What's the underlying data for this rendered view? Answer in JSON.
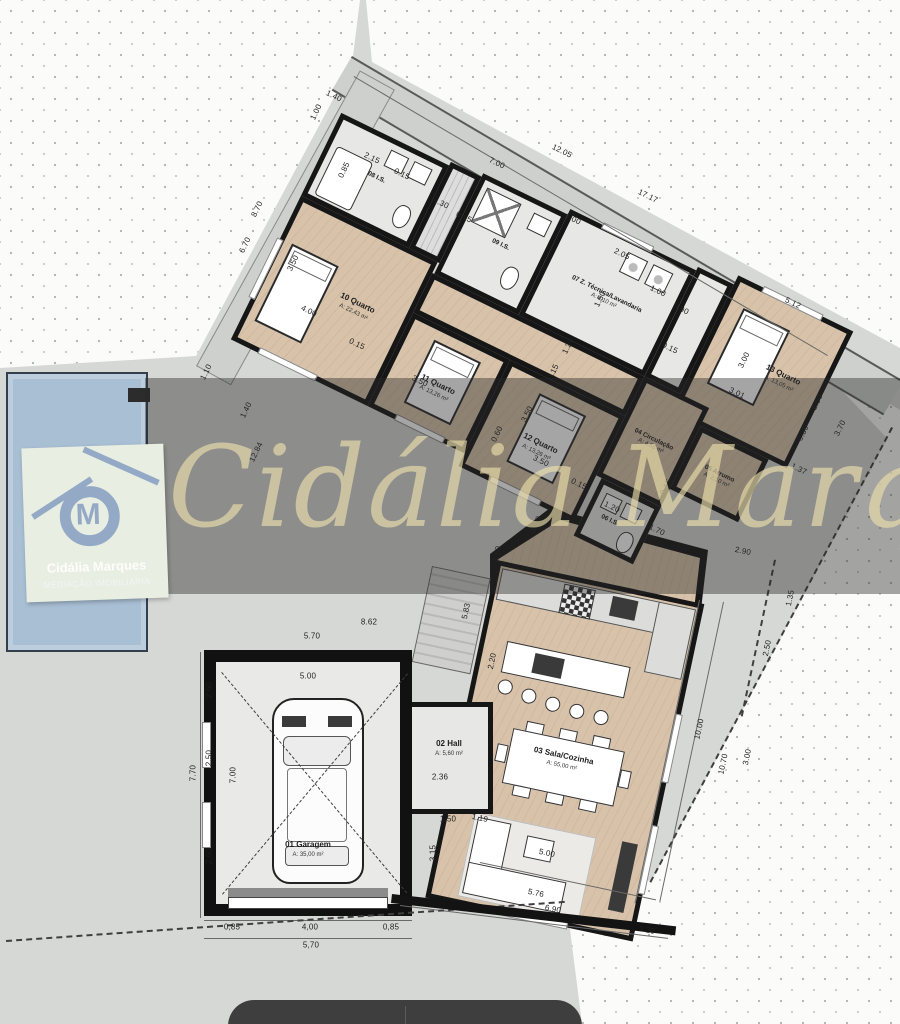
{
  "watermark": {
    "script_text": "Cidália Marques"
  },
  "logo": {
    "monogram": "M",
    "line1": "Cidália Marques",
    "line2": "MEDIAÇÃO IMOBILIÁRIA"
  },
  "rooms": {
    "r10": {
      "name": "10 Quarto",
      "area": "A: 22,43 m²"
    },
    "r11": {
      "name": "11 Quarto",
      "area": "A: 13,26 m²"
    },
    "r12": {
      "name": "12 Quarto",
      "area": "A: 13,26 m²"
    },
    "r13": {
      "name": "13 Quarto",
      "area": "A: 13,05 m²"
    },
    "is08": {
      "name": "08 I.S.",
      "area": "A: 5,13 m²"
    },
    "is09": {
      "name": "09 I.S.",
      "area": "A: 4,50 m²"
    },
    "laundry": {
      "name": "07 Z. Técnica/Lavandaria",
      "area": "A: 8,10 m²"
    },
    "arrumo": {
      "name": "05 Arrumo",
      "area": "A: 2,10 m²"
    },
    "circ": {
      "name": "04 Circulação",
      "area": "A: 4,65 m²"
    },
    "wc06": {
      "name": "06 I.S.",
      "area": "A: 2,40 m²"
    },
    "sala": {
      "name": "03 Sala/Cozinha",
      "area": "A: 55,00 m²"
    },
    "hall": {
      "name": "02 Hall",
      "area": "A: 5,60 m²"
    },
    "garage": {
      "name": "01 Garagem",
      "area": "A: 35,00 m²"
    }
  },
  "colors": {
    "wall": "#161616",
    "wood_floor": "#d8c3aa",
    "tile_floor": "#e7e7e5",
    "pool": "#a9bfd4",
    "watermark_band": "rgba(40,40,40,0.42)",
    "script_gold": "rgba(235,222,170,0.65)",
    "logo_mark": "#93a9c6",
    "logo_bg": "#e8eee1"
  },
  "dims": [
    {
      "t": "1.40",
      "x": 334,
      "y": 96,
      "r": 26
    },
    {
      "t": "1.00",
      "x": 316,
      "y": 112,
      "r": -64
    },
    {
      "t": "2.15",
      "x": 372,
      "y": 158,
      "r": 26
    },
    {
      "t": "0.85",
      "x": 344,
      "y": 170,
      "r": -64
    },
    {
      "t": "0.15",
      "x": 402,
      "y": 174,
      "r": 26
    },
    {
      "t": "7.00",
      "x": 497,
      "y": 163,
      "r": 26
    },
    {
      "t": "12.05",
      "x": 562,
      "y": 151,
      "r": 26
    },
    {
      "t": "17.17",
      "x": 648,
      "y": 196,
      "r": 26
    },
    {
      "t": "1.00",
      "x": 573,
      "y": 219,
      "r": 26
    },
    {
      "t": "2.05",
      "x": 622,
      "y": 254,
      "r": 26
    },
    {
      "t": "1.00",
      "x": 658,
      "y": 291,
      "r": 26
    },
    {
      "t": "0.90",
      "x": 681,
      "y": 309,
      "r": 26
    },
    {
      "t": "5.12",
      "x": 793,
      "y": 303,
      "r": 26
    },
    {
      "t": "2.30",
      "x": 441,
      "y": 203,
      "r": 26
    },
    {
      "t": "0.15",
      "x": 464,
      "y": 217,
      "r": 26
    },
    {
      "t": "8.70",
      "x": 257,
      "y": 209,
      "r": -64
    },
    {
      "t": "6.70",
      "x": 245,
      "y": 245,
      "r": -64
    },
    {
      "t": "1.10",
      "x": 206,
      "y": 372,
      "r": -64
    },
    {
      "t": "1.40",
      "x": 246,
      "y": 410,
      "r": -64
    },
    {
      "t": "3.50",
      "x": 293,
      "y": 263,
      "r": -64
    },
    {
      "t": "4.00",
      "x": 309,
      "y": 311,
      "r": 26
    },
    {
      "t": "0.15",
      "x": 357,
      "y": 344,
      "r": 26
    },
    {
      "t": "3.50",
      "x": 420,
      "y": 381,
      "r": 26
    },
    {
      "t": "12.84",
      "x": 256,
      "y": 452,
      "r": -64
    },
    {
      "t": "3.50",
      "x": 527,
      "y": 414,
      "r": -64
    },
    {
      "t": "0.60",
      "x": 497,
      "y": 434,
      "r": -64
    },
    {
      "t": "3.50",
      "x": 541,
      "y": 461,
      "r": 26
    },
    {
      "t": "0.15",
      "x": 579,
      "y": 484,
      "r": 26
    },
    {
      "t": "1.20",
      "x": 612,
      "y": 507,
      "r": 26
    },
    {
      "t": "1.10",
      "x": 536,
      "y": 524,
      "r": -64
    },
    {
      "t": "1.50",
      "x": 600,
      "y": 299,
      "r": -64
    },
    {
      "t": "1.20",
      "x": 568,
      "y": 346,
      "r": -64
    },
    {
      "t": "0.15",
      "x": 553,
      "y": 372,
      "r": -64
    },
    {
      "t": "0.15",
      "x": 670,
      "y": 348,
      "r": 26
    },
    {
      "t": "2.93",
      "x": 684,
      "y": 458,
      "r": -64
    },
    {
      "t": "0.15",
      "x": 666,
      "y": 487,
      "r": -64
    },
    {
      "t": "1.70",
      "x": 657,
      "y": 530,
      "r": 26
    },
    {
      "t": "3.01",
      "x": 737,
      "y": 393,
      "r": 26
    },
    {
      "t": "3.00",
      "x": 744,
      "y": 360,
      "r": -64
    },
    {
      "t": "2.50",
      "x": 817,
      "y": 402,
      "r": -64
    },
    {
      "t": "0.39",
      "x": 803,
      "y": 433,
      "r": -64
    },
    {
      "t": "3.70",
      "x": 840,
      "y": 428,
      "r": -64
    },
    {
      "t": "1.37",
      "x": 799,
      "y": 469,
      "r": 26
    },
    {
      "t": "2.90",
      "x": 743,
      "y": 551,
      "r": 12
    },
    {
      "t": "1.35",
      "x": 790,
      "y": 598,
      "r": -78
    },
    {
      "t": "2.50",
      "x": 767,
      "y": 648,
      "r": -78
    },
    {
      "t": "10.00",
      "x": 699,
      "y": 729,
      "r": -78
    },
    {
      "t": "10.70",
      "x": 723,
      "y": 764,
      "r": -78
    },
    {
      "t": "3.00",
      "x": 747,
      "y": 757,
      "r": -78
    },
    {
      "t": "5.00",
      "x": 547,
      "y": 853,
      "r": 12
    },
    {
      "t": "5.76",
      "x": 536,
      "y": 893,
      "r": 12
    },
    {
      "t": "6.90",
      "x": 553,
      "y": 909,
      "r": 12
    },
    {
      "t": "1.20",
      "x": 647,
      "y": 930,
      "r": 12
    },
    {
      "t": "8.62",
      "x": 369,
      "y": 622,
      "r": 0
    },
    {
      "t": "5.70",
      "x": 312,
      "y": 636,
      "r": 0
    },
    {
      "t": "5.00",
      "x": 308,
      "y": 676,
      "r": 0
    },
    {
      "t": "2.60",
      "x": 209,
      "y": 690,
      "r": -90
    },
    {
      "t": "2.50",
      "x": 209,
      "y": 758,
      "r": -90
    },
    {
      "t": "2.60",
      "x": 209,
      "y": 856,
      "r": -90
    },
    {
      "t": "7.70",
      "x": 193,
      "y": 773,
      "r": -90
    },
    {
      "t": "7.00",
      "x": 233,
      "y": 775,
      "r": -90
    },
    {
      "t": "0,85",
      "x": 232,
      "y": 927,
      "r": 0
    },
    {
      "t": "4,00",
      "x": 310,
      "y": 927,
      "r": 0
    },
    {
      "t": "0,85",
      "x": 391,
      "y": 927,
      "r": 0
    },
    {
      "t": "5,70",
      "x": 311,
      "y": 945,
      "r": 0
    },
    {
      "t": "3.15",
      "x": 433,
      "y": 853,
      "r": -90
    },
    {
      "t": "1,50",
      "x": 448,
      "y": 819,
      "r": 0
    },
    {
      "t": "1.19",
      "x": 480,
      "y": 818,
      "r": 12
    },
    {
      "t": "2.36",
      "x": 440,
      "y": 777,
      "r": 0
    },
    {
      "t": "5.83",
      "x": 466,
      "y": 611,
      "r": -78
    },
    {
      "t": "2.20",
      "x": 492,
      "y": 661,
      "r": -78
    },
    {
      "t": "2.50",
      "x": 497,
      "y": 554,
      "r": -78
    }
  ]
}
